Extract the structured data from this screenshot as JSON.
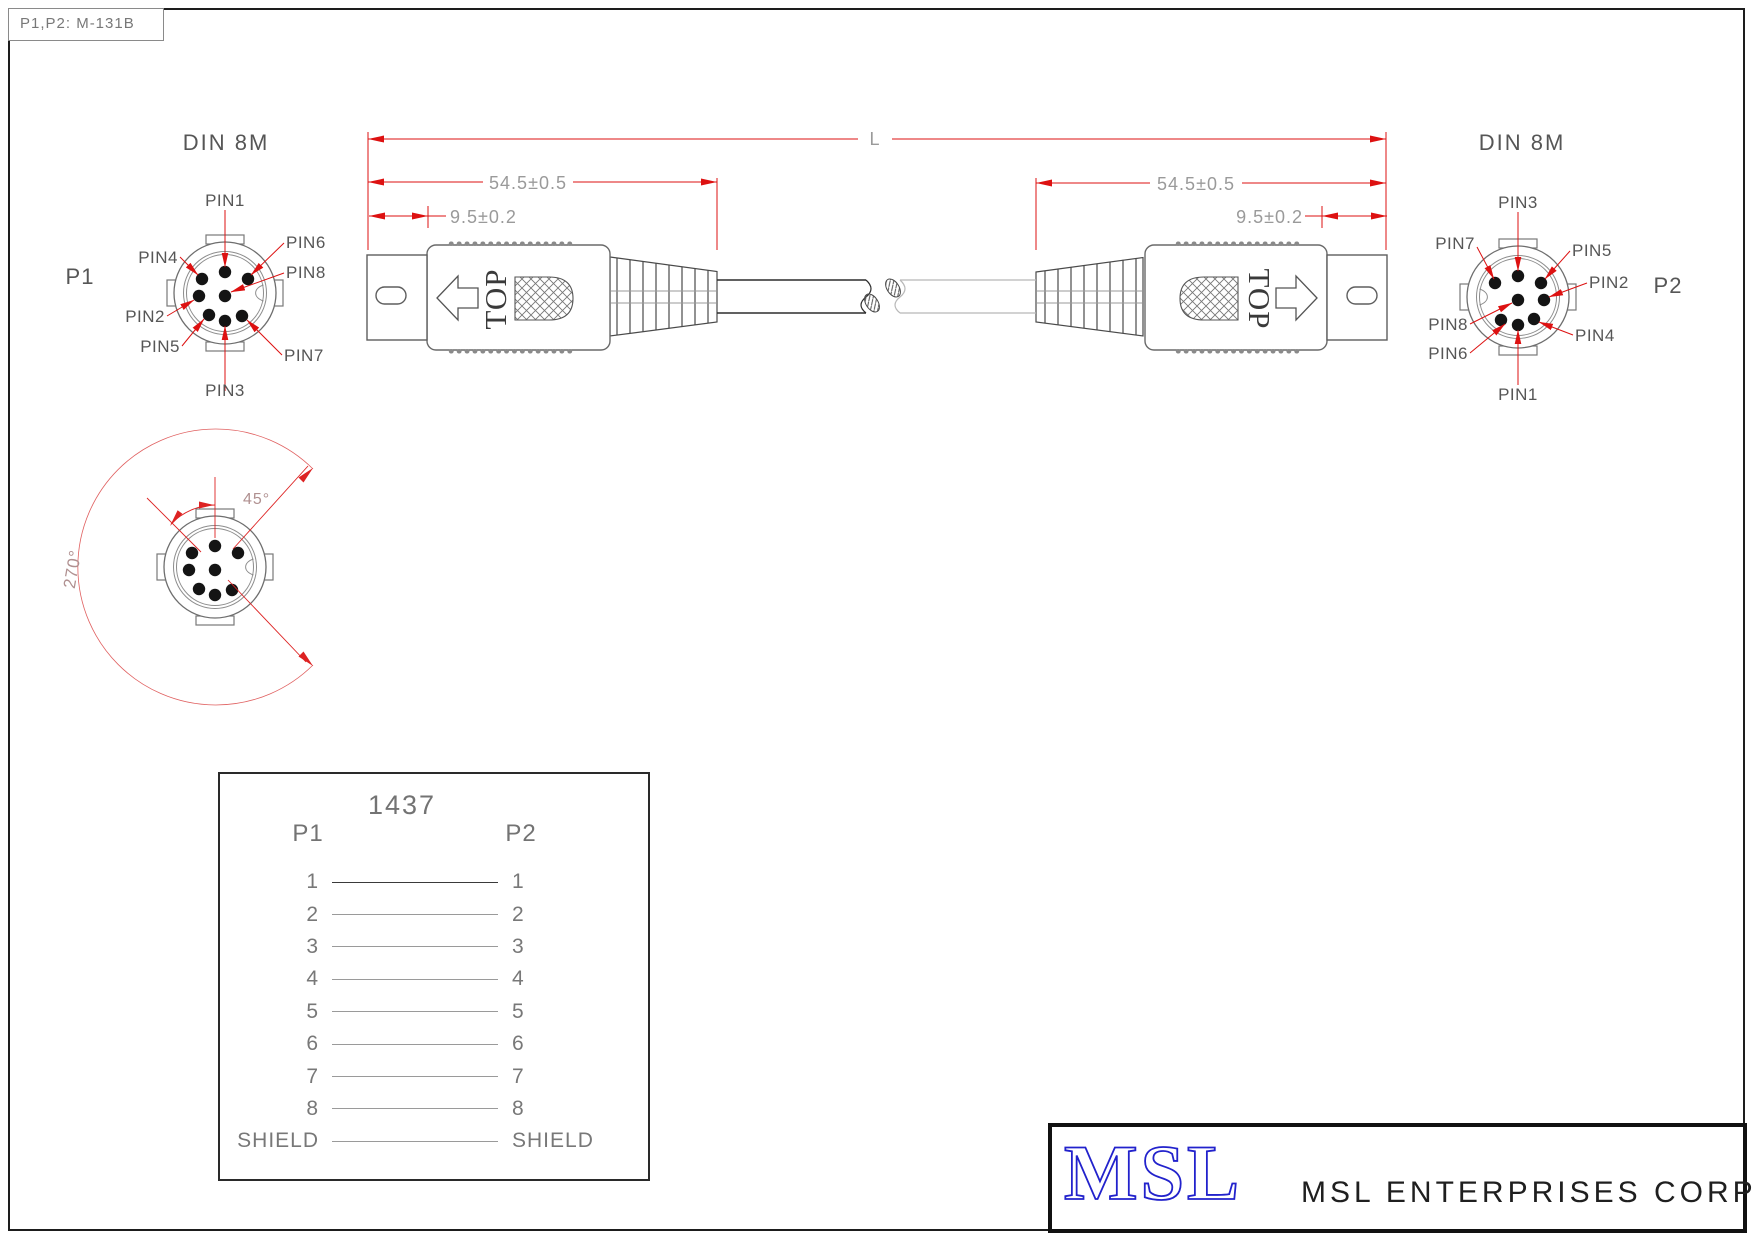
{
  "title_box": {
    "text": "P1,P2: M-131B"
  },
  "p1": {
    "title": "DIN 8M",
    "name": "P1",
    "pin_labels": {
      "top": "PIN1",
      "top_left": "PIN4",
      "top_right": "PIN6",
      "mid_left": "PIN2",
      "mid_center": "PIN8",
      "bottom_left": "PIN5",
      "bottom_center": "PIN3",
      "bottom_right": "PIN7"
    }
  },
  "p2": {
    "title": "DIN 8M",
    "name": "P2",
    "pin_labels": {
      "top": "PIN3",
      "top_left": "PIN7",
      "top_right": "PIN5",
      "mid_center": "PIN8",
      "mid_right": "PIN2",
      "bottom_left": "PIN6",
      "bottom_center": "PIN1",
      "bottom_right": "PIN4"
    }
  },
  "connector": {
    "top_marking": "TOP"
  },
  "dimensions": {
    "overall": "L",
    "body_length": "54.5±0.5",
    "tip_length": "9.5±0.2"
  },
  "rotation": {
    "angle_small": "45°",
    "angle_large": "270°"
  },
  "wiring": {
    "part_number": "1437",
    "col_left": "P1",
    "col_right": "P2",
    "rows": [
      [
        "1",
        "1"
      ],
      [
        "2",
        "2"
      ],
      [
        "3",
        "3"
      ],
      [
        "4",
        "4"
      ],
      [
        "5",
        "5"
      ],
      [
        "6",
        "6"
      ],
      [
        "7",
        "7"
      ],
      [
        "8",
        "8"
      ],
      [
        "SHIELD",
        "SHIELD"
      ]
    ]
  },
  "brand": {
    "logo": "MSL",
    "company": "MSL ENTERPRISES CORP.",
    "logo_color": "#2222cc"
  },
  "colors": {
    "dimension_red": "#dd1111",
    "dim_text_gray": "#9a9a9a",
    "label_gray": "#565656"
  }
}
